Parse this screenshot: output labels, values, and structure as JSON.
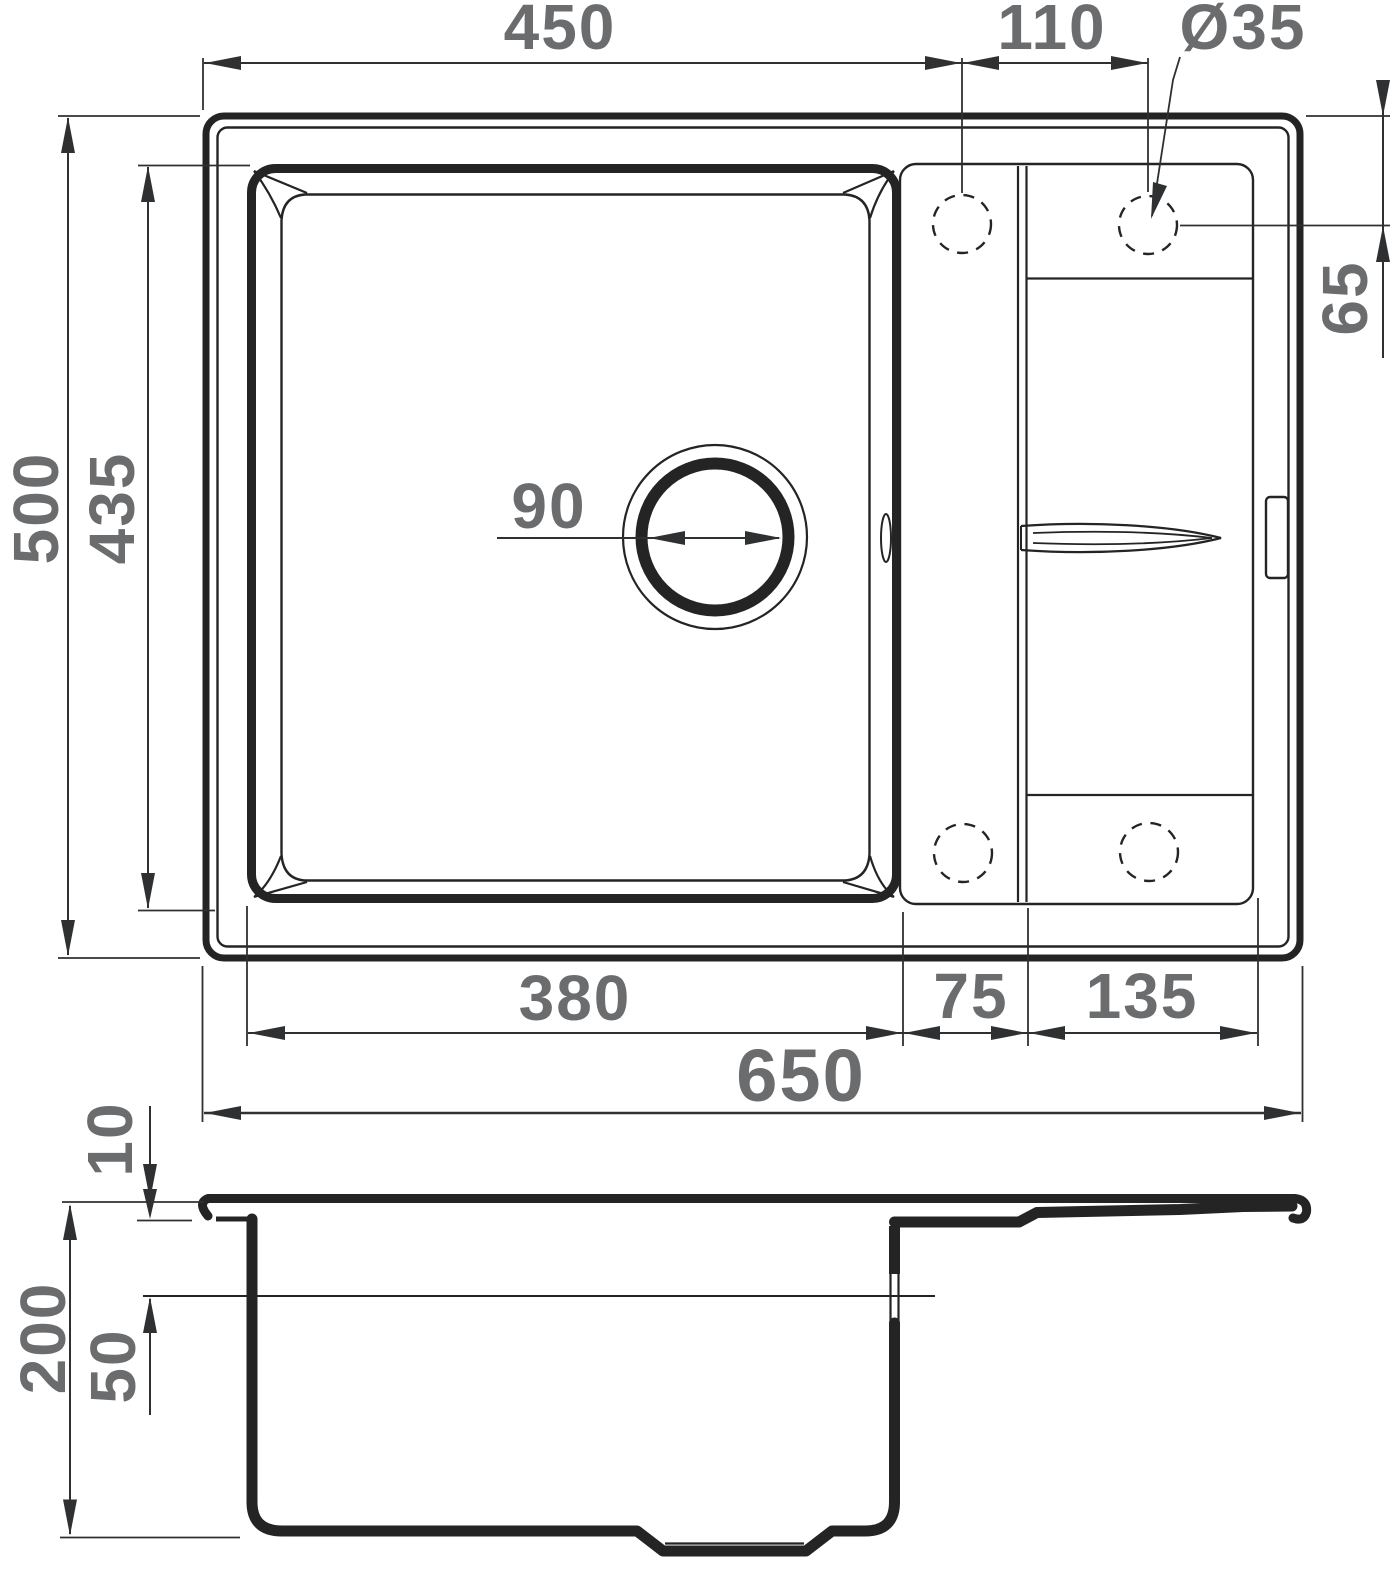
{
  "drawing": {
    "type": "technical-dimension-drawing",
    "subject": "kitchen sink with drainboard — top view and cross-section",
    "colors": {
      "line": "#242424",
      "dimension_text": "#6b6c6e"
    },
    "dimensions": {
      "top_width": "450",
      "hole_spacing": "110",
      "hole_diameter": "Ø35",
      "overall_depth_top": "500",
      "bowl_depth_top": "435",
      "hole_offset": "65",
      "drain_diameter": "90",
      "bowl_width": "380",
      "deck_width": "75",
      "drainboard_width": "135",
      "overall_width": "650",
      "rim_thickness": "10",
      "overall_height": "200",
      "ledge_height": "50"
    }
  }
}
